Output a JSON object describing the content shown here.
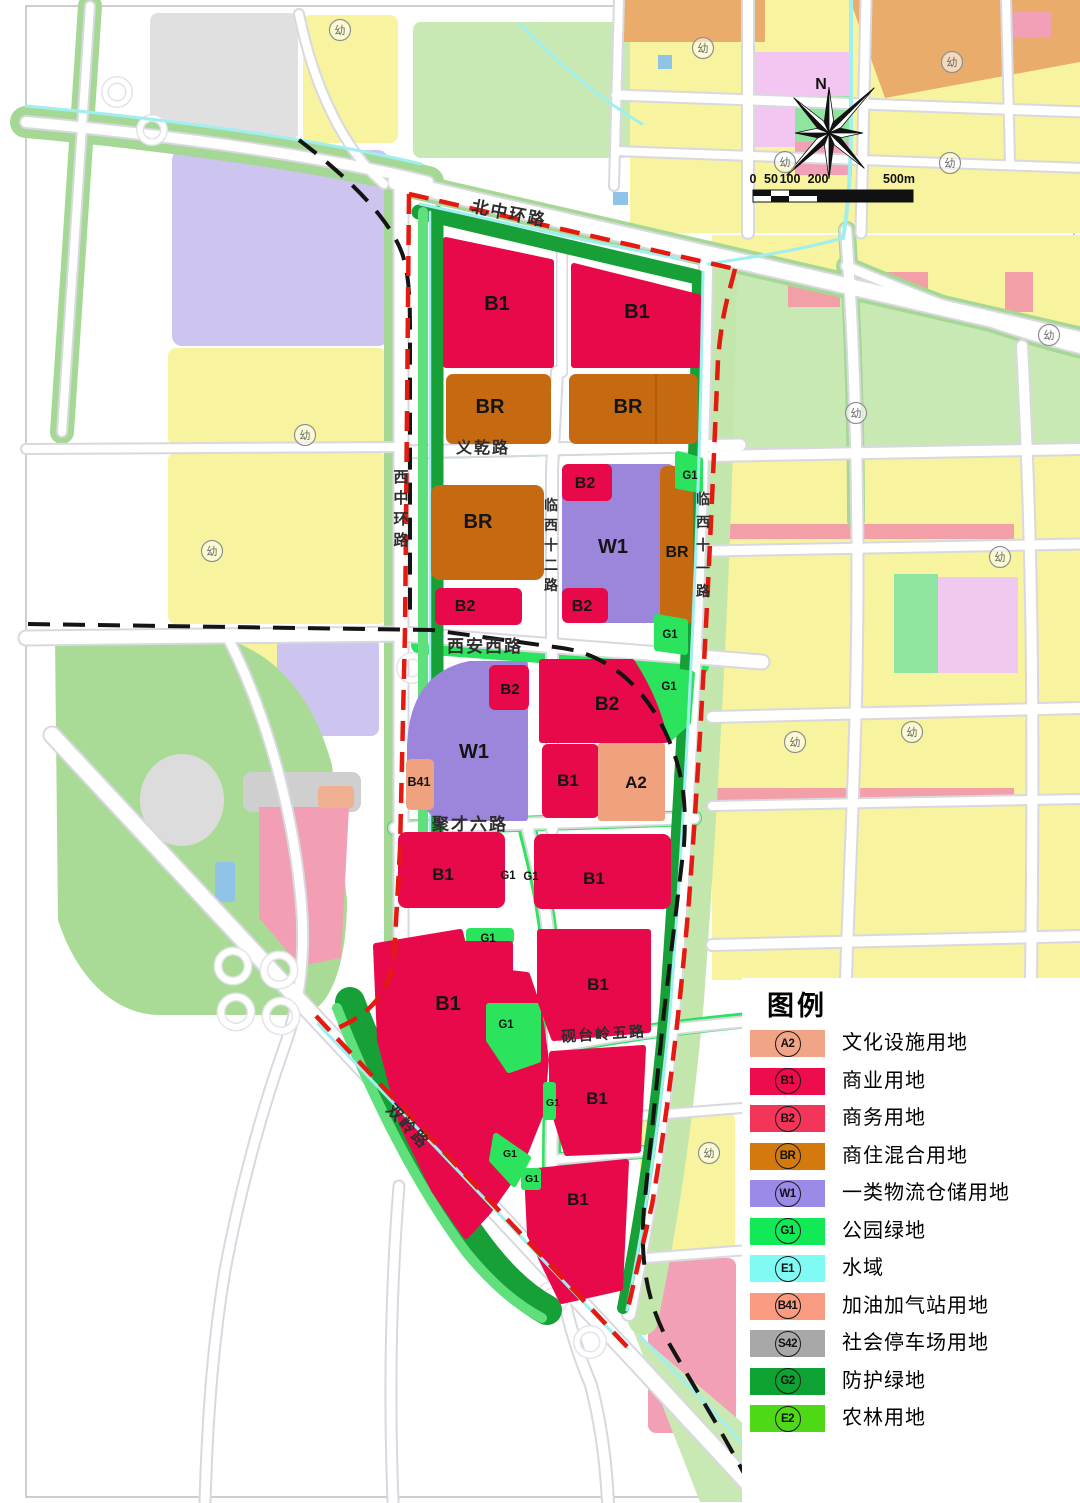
{
  "legend": {
    "title": "图例",
    "items": [
      {
        "code": "A2",
        "label": "文化设施用地",
        "color": "#F2A487"
      },
      {
        "code": "B1",
        "label": "商业用地",
        "color": "#EE0C4C"
      },
      {
        "code": "B2",
        "label": "商务用地",
        "color": "#F23558"
      },
      {
        "code": "BR",
        "label": "商住混合用地",
        "color": "#D3790E"
      },
      {
        "code": "W1",
        "label": "一类物流仓储用地",
        "color": "#9C8AE8"
      },
      {
        "code": "G1",
        "label": "公园绿地",
        "color": "#12E957"
      },
      {
        "code": "E1",
        "label": "水域",
        "color": "#7FFBF3"
      },
      {
        "code": "B41",
        "label": "加油加气站用地",
        "color": "#F89B80"
      },
      {
        "code": "S42",
        "label": "社会停车场用地",
        "color": "#A8A8A8"
      },
      {
        "code": "G2",
        "label": "防护绿地",
        "color": "#0EA233"
      },
      {
        "code": "E2",
        "label": "农林用地",
        "color": "#4FD815"
      }
    ]
  },
  "compass": {
    "north_label": "N"
  },
  "scale_bar": {
    "ticks": [
      "0",
      "50",
      "100",
      "200"
    ],
    "end_label": "500m"
  },
  "map": {
    "road_labels": [
      {
        "text": "北中环路",
        "x": 508,
        "y": 219,
        "size": 17,
        "rot": 11
      },
      {
        "text": "西中环路",
        "x": 402,
        "y": 482,
        "size": 15,
        "vertical": true,
        "dy": 21
      },
      {
        "text": "义乾路",
        "x": 483,
        "y": 453,
        "size": 16
      },
      {
        "text": "临西十二路",
        "x": 552,
        "y": 510,
        "size": 14,
        "vertical": true,
        "dy": 20
      },
      {
        "text": "临西十一路",
        "x": 704,
        "y": 504,
        "size": 14,
        "vertical": true,
        "dy": 23
      },
      {
        "text": "西安西路",
        "x": 485,
        "y": 652,
        "size": 17
      },
      {
        "text": "聚才六路",
        "x": 470,
        "y": 830,
        "size": 17
      },
      {
        "text": "砚台岭五路",
        "x": 604,
        "y": 1039,
        "size": 15,
        "rot": -4
      },
      {
        "text": "双岭路",
        "x": 404,
        "y": 1130,
        "size": 16,
        "rot": 47
      }
    ],
    "zone_labels": [
      {
        "text": "B1",
        "x": 497,
        "y": 310,
        "size": 20
      },
      {
        "text": "B1",
        "x": 637,
        "y": 318,
        "size": 20
      },
      {
        "text": "BR",
        "x": 490,
        "y": 413,
        "size": 20
      },
      {
        "text": "BR",
        "x": 628,
        "y": 413,
        "size": 20
      },
      {
        "text": "BR",
        "x": 478,
        "y": 528,
        "size": 20
      },
      {
        "text": "B2",
        "x": 585,
        "y": 488,
        "size": 16
      },
      {
        "text": "W1",
        "x": 613,
        "y": 553,
        "size": 20
      },
      {
        "text": "BR",
        "x": 677,
        "y": 557,
        "size": 16
      },
      {
        "text": "B2",
        "x": 465,
        "y": 611,
        "size": 16
      },
      {
        "text": "B2",
        "x": 582,
        "y": 611,
        "size": 16
      },
      {
        "text": "G1",
        "x": 690,
        "y": 479,
        "size": 11.5
      },
      {
        "text": "G1",
        "x": 670,
        "y": 638,
        "size": 11.5
      },
      {
        "text": "G1",
        "x": 669,
        "y": 690,
        "size": 11.5
      },
      {
        "text": "B2",
        "x": 510,
        "y": 694,
        "size": 15
      },
      {
        "text": "W1",
        "x": 474,
        "y": 758,
        "size": 20
      },
      {
        "text": "B41",
        "x": 419,
        "y": 786,
        "size": 12.5
      },
      {
        "text": "B2",
        "x": 607,
        "y": 710,
        "size": 19
      },
      {
        "text": "B1",
        "x": 568,
        "y": 786,
        "size": 17
      },
      {
        "text": "A2",
        "x": 636,
        "y": 788,
        "size": 17
      },
      {
        "text": "B1",
        "x": 443,
        "y": 880,
        "size": 17
      },
      {
        "text": "B1",
        "x": 594,
        "y": 884,
        "size": 17
      },
      {
        "text": "G1",
        "x": 508,
        "y": 879,
        "size": 11.5
      },
      {
        "text": "G1",
        "x": 531,
        "y": 880,
        "size": 11.5
      },
      {
        "text": "G1",
        "x": 488,
        "y": 942,
        "size": 11.5
      },
      {
        "text": "B1",
        "x": 448,
        "y": 1010,
        "size": 20
      },
      {
        "text": "G1",
        "x": 506,
        "y": 1028,
        "size": 11.5
      },
      {
        "text": "B1",
        "x": 598,
        "y": 990,
        "size": 17
      },
      {
        "text": "B1",
        "x": 597,
        "y": 1104,
        "size": 17
      },
      {
        "text": "G1",
        "x": 553,
        "y": 1106,
        "size": 10.5
      },
      {
        "text": "G1",
        "x": 510,
        "y": 1157,
        "size": 10.5
      },
      {
        "text": "G1",
        "x": 532,
        "y": 1182,
        "size": 10.5
      },
      {
        "text": "B1",
        "x": 578,
        "y": 1205,
        "size": 17
      }
    ],
    "kindergarten_symbol": "幼",
    "kindergarten_positions": [
      [
        340,
        30
      ],
      [
        703,
        48
      ],
      [
        952,
        62
      ],
      [
        785,
        162
      ],
      [
        950,
        163
      ],
      [
        1049,
        335
      ],
      [
        856,
        413
      ],
      [
        305,
        435
      ],
      [
        212,
        551
      ],
      [
        1000,
        557
      ],
      [
        912,
        732
      ],
      [
        795,
        742
      ],
      [
        709,
        1153
      ]
    ]
  }
}
